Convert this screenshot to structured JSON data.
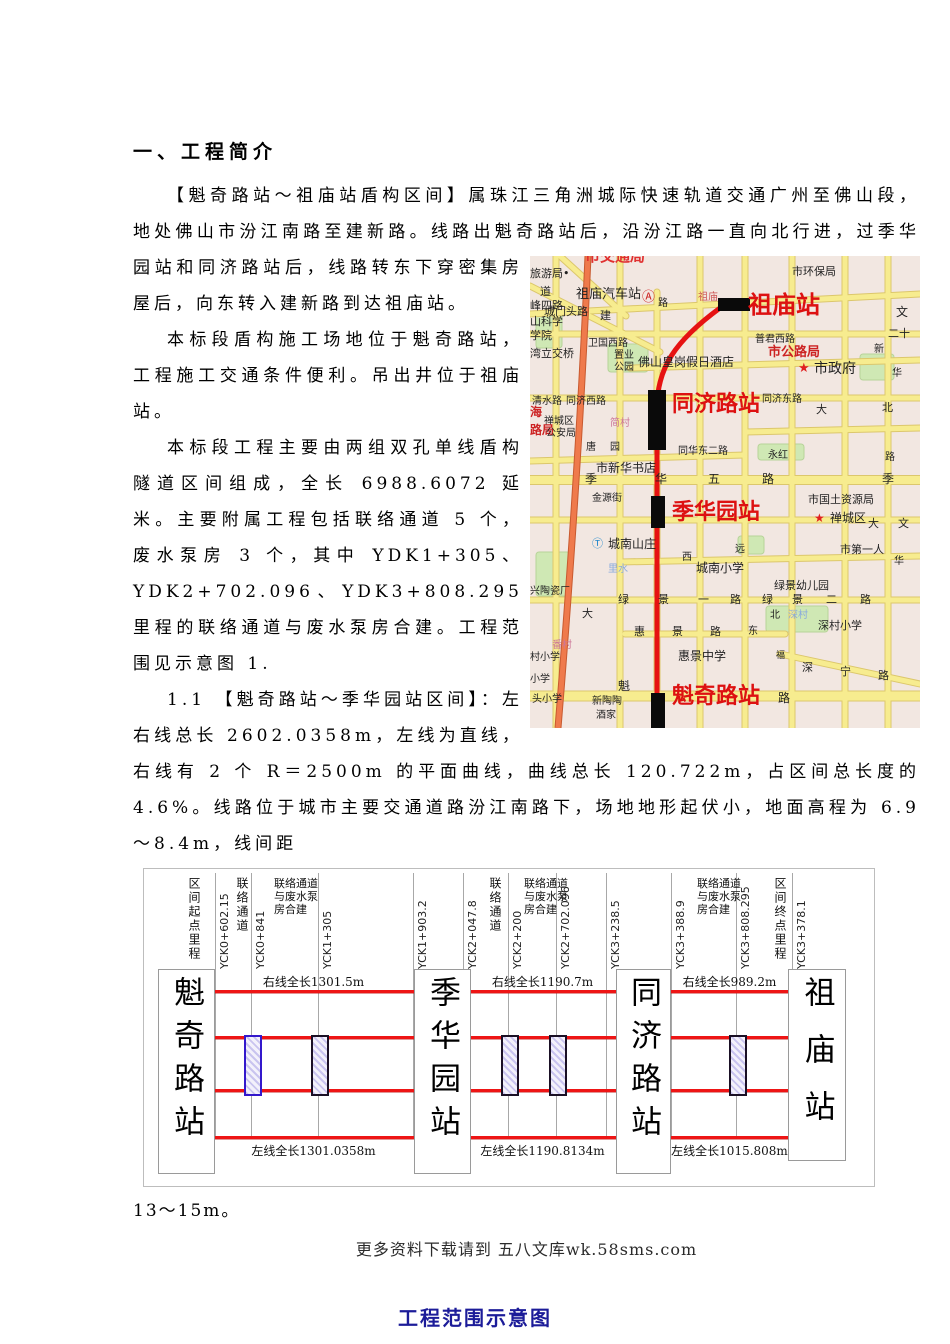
{
  "page": {
    "title": "一、工程简介",
    "paragraphs": [
      "【魁奇路站～祖庙站盾构区间】属珠江三角洲城际快速轨道交通广州至佛山段，地处佛山市汾江南路至建新路。线路出魁奇路站后，沿汾江路一直向北行进，过季华园站和同济路站后，线路转东下穿密集房屋后，向东转入建新路到达祖庙站。",
      "本标段盾构施工场地位于魁奇路站，工程施工交通条件便利。吊出井位于祖庙站。",
      "本标段工程主要由两组双孔单线盾构隧道区间组成，全长 6988.6072 延米。主要附属工程包括联络通道 5 个，废水泵房 3 个，其中 YDK1+305、YDK2+702.096、YDK3+808.295 里程的联络通道与废水泵房合建。工程范围见示意图 1.",
      "1.1 【魁奇路站～季华园站区间】：左右线总长 2602.0358m，左线为直线，右线有 2 个 R＝2500m 的平面曲线，曲线总长 120.722m，占区间总长度的 4.6%。线路位于城市主要交通道路汾江南路下，场地地形起伏小，地面高程为 6.9～8.4m，线间距"
    ],
    "after_figure": "13～15m。",
    "footer": "更多资料下载请到 五八文库wk.58sms.com",
    "caption": "工程范围示意图"
  },
  "colors": {
    "track_red": "#ee1515",
    "metro_red": "#e61212",
    "station_label_red": "#dd1111",
    "caption_blue": "#1c1c99"
  },
  "map": {
    "station_rects": [
      {
        "x": 188,
        "y": 42,
        "w": 32,
        "h": 13
      },
      {
        "x": 118,
        "y": 134,
        "w": 18,
        "h": 60
      },
      {
        "x": 121,
        "y": 240,
        "w": 14,
        "h": 32
      },
      {
        "x": 121,
        "y": 437,
        "w": 14,
        "h": 35
      }
    ],
    "labels": [
      {
        "t": "市交通局",
        "x": 55,
        "y": -8,
        "c": "#e03030",
        "s": 15,
        "b": 1
      },
      {
        "t": "旅游局•",
        "x": 0,
        "y": 12,
        "c": "#222",
        "s": 11
      },
      {
        "t": "市环保局",
        "x": 262,
        "y": 10,
        "c": "#222",
        "s": 11
      },
      {
        "t": "道",
        "x": 10,
        "y": 30,
        "c": "#222",
        "s": 11
      },
      {
        "t": "祖庙汽车站",
        "x": 46,
        "y": 32,
        "c": "#222",
        "s": 13
      },
      {
        "t": "Ⓐ",
        "x": 112,
        "y": 35,
        "c": "#cc2222",
        "s": 13,
        "n": "bus-station-icon"
      },
      {
        "t": "祖庙",
        "x": 168,
        "y": 36,
        "c": "#cc5555",
        "s": 10
      },
      {
        "t": "路",
        "x": 128,
        "y": 42,
        "c": "#222",
        "s": 10
      },
      {
        "t": "祖庙站",
        "x": 218,
        "y": 36,
        "c": "#dd1111",
        "s": 24,
        "b": 1,
        "n": "map-station-label-zumiao"
      },
      {
        "t": "峰四路",
        "x": 0,
        "y": 44,
        "c": "#222",
        "s": 11
      },
      {
        "t": "城门头路",
        "x": 14,
        "y": 50,
        "c": "#222",
        "s": 11
      },
      {
        "t": "建",
        "x": 70,
        "y": 54,
        "c": "#222",
        "s": 11
      },
      {
        "t": "文",
        "x": 366,
        "y": 50,
        "c": "#222",
        "s": 12
      },
      {
        "t": "山科学",
        "x": 0,
        "y": 60,
        "c": "#222",
        "s": 11
      },
      {
        "t": "学院",
        "x": 0,
        "y": 74,
        "c": "#222",
        "s": 11
      },
      {
        "t": "二十",
        "x": 358,
        "y": 72,
        "c": "#222",
        "s": 11
      },
      {
        "t": "普君西路",
        "x": 225,
        "y": 78,
        "c": "#222",
        "s": 10
      },
      {
        "t": "卫国西路",
        "x": 58,
        "y": 82,
        "c": "#222",
        "s": 10
      },
      {
        "t": "市公路局",
        "x": 238,
        "y": 90,
        "c": "#cc2222",
        "s": 13,
        "b": 1
      },
      {
        "t": "湾立交桥",
        "x": 0,
        "y": 92,
        "c": "#222",
        "s": 11
      },
      {
        "t": "新",
        "x": 344,
        "y": 88,
        "c": "#222",
        "s": 10
      },
      {
        "t": "置业",
        "x": 84,
        "y": 94,
        "c": "#222",
        "s": 10
      },
      {
        "t": "公园",
        "x": 84,
        "y": 106,
        "c": "#222",
        "s": 10
      },
      {
        "t": "佛山皇岗假日酒店",
        "x": 108,
        "y": 100,
        "c": "#222",
        "s": 12
      },
      {
        "t": "★",
        "x": 268,
        "y": 106,
        "c": "#e02020",
        "s": 13,
        "n": "star-icon"
      },
      {
        "t": "市政府",
        "x": 284,
        "y": 106,
        "c": "#222",
        "s": 14
      },
      {
        "t": "华",
        "x": 362,
        "y": 112,
        "c": "#222",
        "s": 10
      },
      {
        "t": "清水路",
        "x": 2,
        "y": 140,
        "c": "#222",
        "s": 10
      },
      {
        "t": "同济西路",
        "x": 36,
        "y": 140,
        "c": "#222",
        "s": 10
      },
      {
        "t": "同济路站",
        "x": 142,
        "y": 136,
        "c": "#dd1111",
        "s": 22,
        "b": 1,
        "n": "map-station-label-tongjilu"
      },
      {
        "t": "同济东路",
        "x": 232,
        "y": 138,
        "c": "#222",
        "s": 10
      },
      {
        "t": "大",
        "x": 286,
        "y": 148,
        "c": "#222",
        "s": 11
      },
      {
        "t": "北",
        "x": 352,
        "y": 146,
        "c": "#222",
        "s": 11
      },
      {
        "t": "海",
        "x": 0,
        "y": 150,
        "c": "#cc2222",
        "s": 12,
        "b": 1
      },
      {
        "t": "禅城区",
        "x": 14,
        "y": 160,
        "c": "#222",
        "s": 10
      },
      {
        "t": "简村",
        "x": 80,
        "y": 162,
        "c": "#cc7799",
        "s": 10
      },
      {
        "t": "路局",
        "x": 0,
        "y": 168,
        "c": "#cc2222",
        "s": 12,
        "b": 1
      },
      {
        "t": "公安局",
        "x": 16,
        "y": 172,
        "c": "#222",
        "s": 10
      },
      {
        "t": "唐",
        "x": 56,
        "y": 186,
        "c": "#222",
        "s": 10
      },
      {
        "t": "园",
        "x": 80,
        "y": 186,
        "c": "#222",
        "s": 10
      },
      {
        "t": "同华东二路",
        "x": 148,
        "y": 190,
        "c": "#222",
        "s": 10
      },
      {
        "t": "永红",
        "x": 238,
        "y": 194,
        "c": "#222",
        "s": 10
      },
      {
        "t": "路",
        "x": 355,
        "y": 196,
        "c": "#222",
        "s": 10
      },
      {
        "t": "市新华书店",
        "x": 66,
        "y": 206,
        "c": "#222",
        "s": 12
      },
      {
        "t": "季",
        "x": 55,
        "y": 217,
        "c": "#222",
        "s": 12
      },
      {
        "t": "华",
        "x": 125,
        "y": 217,
        "c": "#222",
        "s": 12
      },
      {
        "t": "五",
        "x": 178,
        "y": 217,
        "c": "#222",
        "s": 12
      },
      {
        "t": "路",
        "x": 232,
        "y": 217,
        "c": "#222",
        "s": 12
      },
      {
        "t": "季",
        "x": 352,
        "y": 217,
        "c": "#222",
        "s": 12
      },
      {
        "t": "金源街",
        "x": 62,
        "y": 237,
        "c": "#222",
        "s": 10
      },
      {
        "t": "季华园站",
        "x": 142,
        "y": 244,
        "c": "#dd1111",
        "s": 22,
        "b": 1,
        "n": "map-station-label-jihuayuan"
      },
      {
        "t": "市国土资源局",
        "x": 278,
        "y": 238,
        "c": "#222",
        "s": 11
      },
      {
        "t": "★",
        "x": 284,
        "y": 256,
        "c": "#e02020",
        "s": 12,
        "n": "star-icon"
      },
      {
        "t": "禅城区",
        "x": 300,
        "y": 256,
        "c": "#222",
        "s": 12
      },
      {
        "t": "大",
        "x": 338,
        "y": 262,
        "c": "#222",
        "s": 11
      },
      {
        "t": "文",
        "x": 368,
        "y": 262,
        "c": "#222",
        "s": 11
      },
      {
        "t": "Ⓣ",
        "x": 62,
        "y": 282,
        "c": "#2288cc",
        "s": 11,
        "n": "landmark-icon"
      },
      {
        "t": "城南山庄",
        "x": 78,
        "y": 282,
        "c": "#222",
        "s": 12
      },
      {
        "t": "市第一人",
        "x": 310,
        "y": 288,
        "c": "#222",
        "s": 11
      },
      {
        "t": "西",
        "x": 152,
        "y": 296,
        "c": "#222",
        "s": 10
      },
      {
        "t": "远",
        "x": 205,
        "y": 288,
        "c": "#222",
        "s": 10
      },
      {
        "t": "里水",
        "x": 78,
        "y": 308,
        "c": "#88aadd",
        "s": 10
      },
      {
        "t": "城南小学",
        "x": 166,
        "y": 306,
        "c": "#222",
        "s": 12
      },
      {
        "t": "华",
        "x": 364,
        "y": 300,
        "c": "#222",
        "s": 10
      },
      {
        "t": "绿景幼儿园",
        "x": 244,
        "y": 324,
        "c": "#222",
        "s": 11
      },
      {
        "t": "兴陶瓷厂",
        "x": 0,
        "y": 330,
        "c": "#222",
        "s": 10
      },
      {
        "t": "绿",
        "x": 88,
        "y": 338,
        "c": "#222",
        "s": 11
      },
      {
        "t": "景",
        "x": 128,
        "y": 338,
        "c": "#222",
        "s": 11
      },
      {
        "t": "一",
        "x": 168,
        "y": 338,
        "c": "#222",
        "s": 11
      },
      {
        "t": "路",
        "x": 200,
        "y": 338,
        "c": "#222",
        "s": 11
      },
      {
        "t": "绿",
        "x": 232,
        "y": 338,
        "c": "#222",
        "s": 11
      },
      {
        "t": "景",
        "x": 262,
        "y": 338,
        "c": "#222",
        "s": 11
      },
      {
        "t": "二",
        "x": 296,
        "y": 338,
        "c": "#222",
        "s": 11
      },
      {
        "t": "路",
        "x": 330,
        "y": 338,
        "c": "#222",
        "s": 11
      },
      {
        "t": "大",
        "x": 52,
        "y": 352,
        "c": "#222",
        "s": 11
      },
      {
        "t": "北",
        "x": 240,
        "y": 354,
        "c": "#222",
        "s": 10
      },
      {
        "t": "深村",
        "x": 258,
        "y": 354,
        "c": "#88aadd",
        "s": 10
      },
      {
        "t": "东",
        "x": 218,
        "y": 370,
        "c": "#222",
        "s": 10
      },
      {
        "t": "深村小学",
        "x": 288,
        "y": 364,
        "c": "#222",
        "s": 11
      },
      {
        "t": "惠",
        "x": 104,
        "y": 370,
        "c": "#222",
        "s": 11
      },
      {
        "t": "景",
        "x": 142,
        "y": 370,
        "c": "#222",
        "s": 11
      },
      {
        "t": "路",
        "x": 180,
        "y": 370,
        "c": "#222",
        "s": 11
      },
      {
        "t": "番村",
        "x": 22,
        "y": 384,
        "c": "#cc7799",
        "s": 10
      },
      {
        "t": "村小学",
        "x": 0,
        "y": 396,
        "c": "#222",
        "s": 10
      },
      {
        "t": "惠景中学",
        "x": 148,
        "y": 394,
        "c": "#222",
        "s": 12
      },
      {
        "t": "福",
        "x": 246,
        "y": 396,
        "c": "#222",
        "s": 9
      },
      {
        "t": "深",
        "x": 272,
        "y": 406,
        "c": "#222",
        "s": 11
      },
      {
        "t": "宁",
        "x": 310,
        "y": 410,
        "c": "#222",
        "s": 11
      },
      {
        "t": "路",
        "x": 348,
        "y": 414,
        "c": "#222",
        "s": 11
      },
      {
        "t": "小学",
        "x": 0,
        "y": 418,
        "c": "#222",
        "s": 10
      },
      {
        "t": "魁",
        "x": 88,
        "y": 424,
        "c": "#222",
        "s": 12
      },
      {
        "t": "魁奇路站",
        "x": 142,
        "y": 428,
        "c": "#dd1111",
        "s": 22,
        "b": 1,
        "n": "map-station-label-kuiqilu"
      },
      {
        "t": "路",
        "x": 248,
        "y": 436,
        "c": "#222",
        "s": 12
      },
      {
        "t": "头小学",
        "x": 2,
        "y": 438,
        "c": "#222",
        "s": 10
      },
      {
        "t": "新陶陶",
        "x": 62,
        "y": 440,
        "c": "#222",
        "s": 10
      },
      {
        "t": "酒家",
        "x": 66,
        "y": 454,
        "c": "#222",
        "s": 10
      }
    ]
  },
  "figure": {
    "top_labels": [
      {
        "t": "区间起点里程",
        "x": 42,
        "type": "v"
      },
      {
        "t": "YCK0+602.15",
        "x": 73,
        "type": "r"
      },
      {
        "t": "联络通道",
        "x": 90,
        "type": "v"
      },
      {
        "t": "YCK0+841",
        "x": 109,
        "type": "r"
      },
      {
        "t": "联络通道与废水泵房合建",
        "x": 130,
        "type": "w"
      },
      {
        "t": "YCK1+305",
        "x": 176,
        "type": "r"
      },
      {
        "t": "YCK1+903.2",
        "x": 271,
        "type": "r"
      },
      {
        "t": "YCK2+047.8",
        "x": 321,
        "type": "r"
      },
      {
        "t": "联络通道",
        "x": 343,
        "type": "v"
      },
      {
        "t": "YCK2+200",
        "x": 366,
        "type": "r"
      },
      {
        "t": "联络通道与废水泵房合建",
        "x": 380,
        "type": "w"
      },
      {
        "t": "YCK2+702.096",
        "x": 414,
        "type": "r"
      },
      {
        "t": "YCK3+238.5",
        "x": 464,
        "type": "r"
      },
      {
        "t": "YCK3+388.9",
        "x": 529,
        "type": "r"
      },
      {
        "t": "联络通道与废水泵房合建",
        "x": 553,
        "type": "w"
      },
      {
        "t": "YCK3+808.295",
        "x": 594,
        "type": "r"
      },
      {
        "t": "区间终点里程",
        "x": 628,
        "type": "v"
      },
      {
        "t": "YCK3+378.1",
        "x": 650,
        "type": "r"
      }
    ],
    "ticks": [
      71,
      107,
      174,
      269,
      319,
      364,
      412,
      462,
      527,
      592,
      648
    ],
    "stations": [
      {
        "name": "魁奇路站",
        "x": 14,
        "w": 55,
        "h": 203
      },
      {
        "name": "季华园站",
        "x": 270,
        "w": 55,
        "h": 203
      },
      {
        "name": "同济路站",
        "x": 472,
        "w": 53,
        "h": 203
      },
      {
        "name": "祖庙站",
        "x": 644,
        "w": 56,
        "h": 190
      }
    ],
    "segments": [
      {
        "x1": 69,
        "x2": 270,
        "right": "右线全长1301.5m",
        "left": "左线全长1301.0358m"
      },
      {
        "x1": 325,
        "x2": 472,
        "right": "右线全长1190.7m",
        "left": "左线全长1190.8134m"
      },
      {
        "x1": 525,
        "x2": 646,
        "right": "右线全长989.2m",
        "left": "左线全长1015.808m"
      }
    ],
    "passages": [
      {
        "x": 100,
        "border": "#3318cc"
      },
      {
        "x": 167,
        "border": "#1a1025"
      },
      {
        "x": 357,
        "border": "#1a1025"
      },
      {
        "x": 405,
        "border": "#1a1025"
      },
      {
        "x": 585,
        "border": "#1a1025"
      }
    ]
  }
}
